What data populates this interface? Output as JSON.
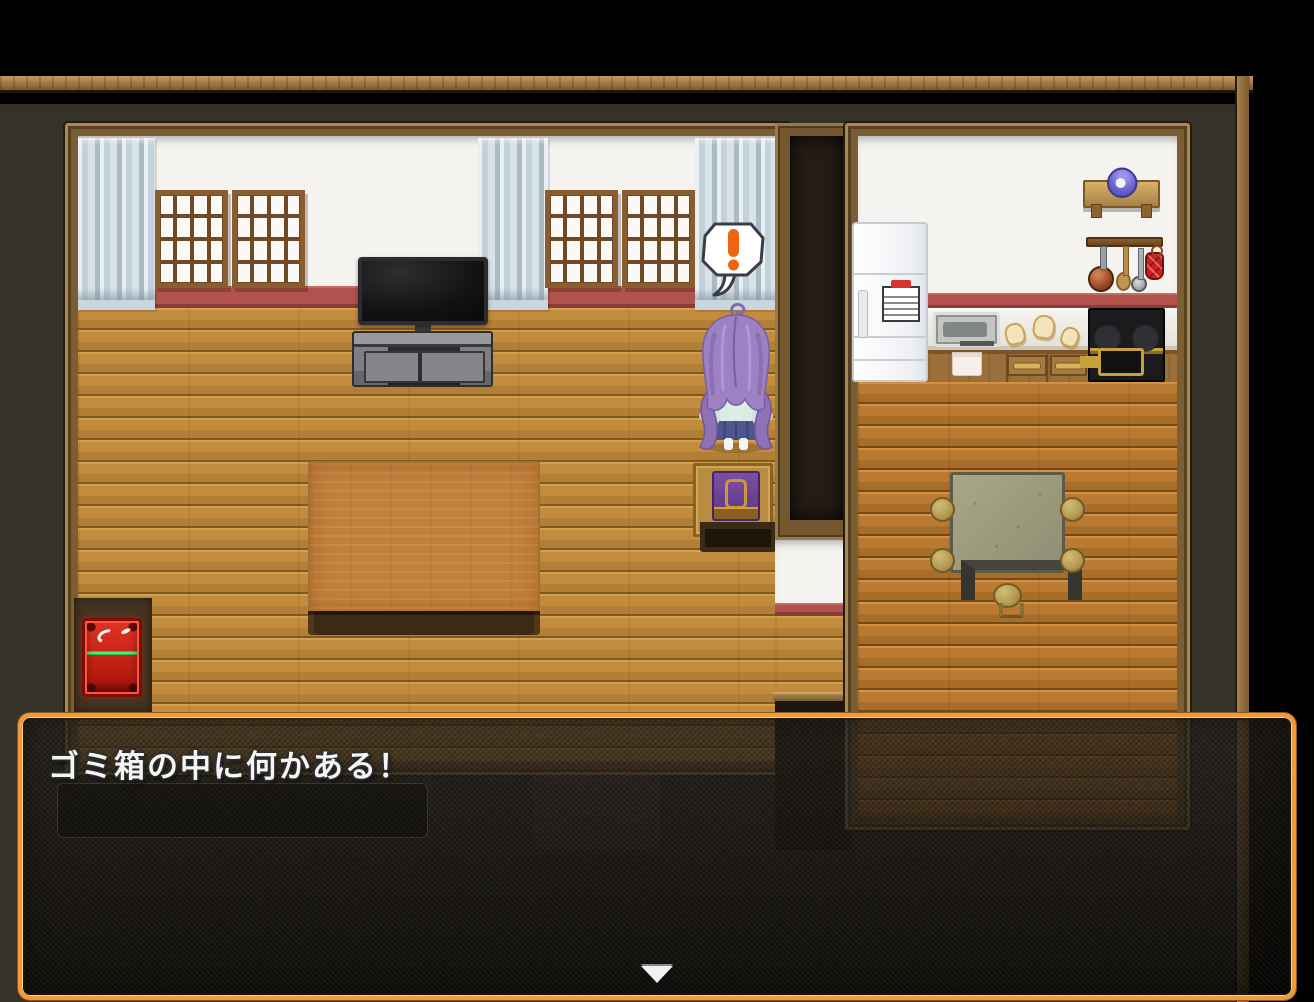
{
  "message_window": {
    "text": "ゴミ箱の中に何かある！"
  },
  "balloon": {
    "symbol": "!"
  },
  "icons": {
    "continue_arrow": "down-triangle",
    "balloon_exclamation": "orange-exclamation-mark"
  },
  "colors": {
    "accent-orange": "#f09a3c",
    "exclamation-orange": "#ee6410",
    "message-text": "#f5f5f5",
    "trash-red": "#c81818",
    "baseboard-red": "#b2524c",
    "floor-living": "#c28c3e",
    "floor-kitchen": "#bb7a32",
    "curtain-blue": "#c9d6de",
    "hair-purple": "#9c81c3",
    "outer-wall": "#36322a"
  }
}
